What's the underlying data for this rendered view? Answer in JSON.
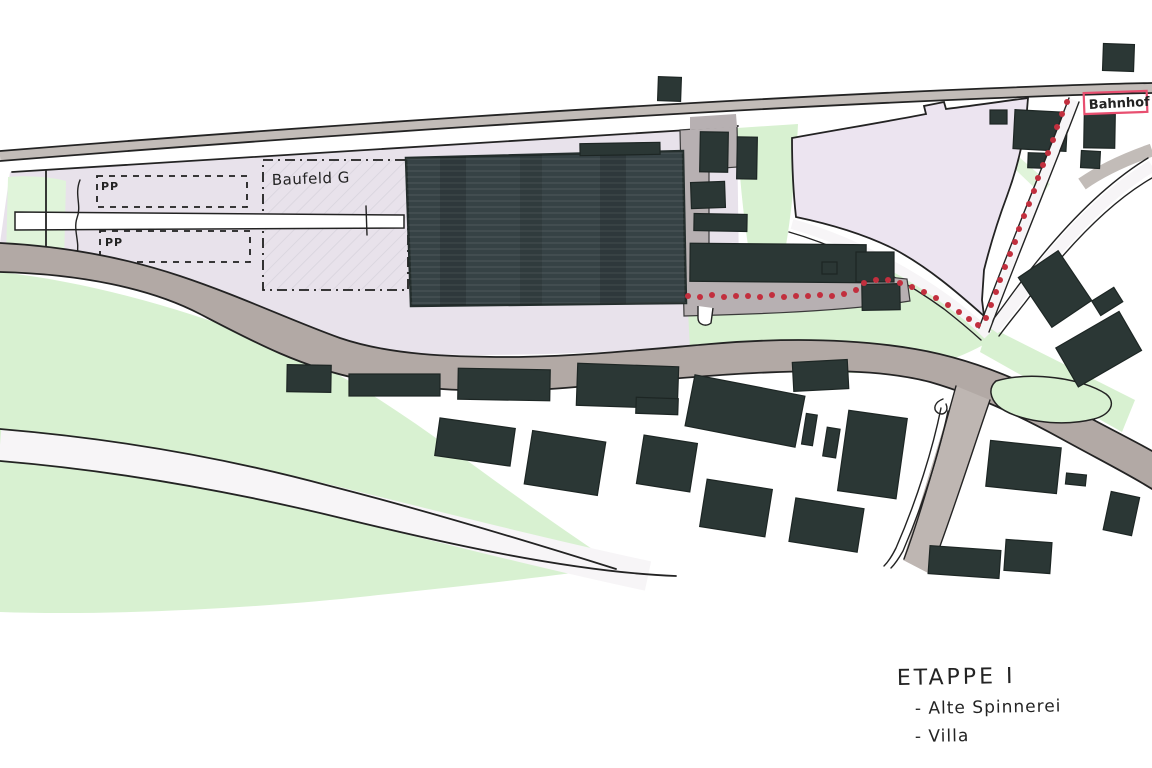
{
  "map": {
    "title": "Hand-drawn site plan sketch",
    "labels": {
      "pp_top": "PP",
      "pp_bottom": "PP",
      "baufeld": "Baufeld G",
      "bahnhof": "Bahnhof"
    }
  },
  "notes": {
    "title": "ETAPPE  I",
    "items": [
      "- Alte Spinnerei",
      "- Villa"
    ]
  },
  "colors": {
    "building_dark": "#2b3735",
    "main_hall": "#364245",
    "field_green": "#d8f1d1",
    "site_lavender": "#e8e2eb",
    "meadow_lavender": "#ece4f0",
    "road_gray": "#b2a9a5",
    "railway_gray": "#c2bcb8",
    "courtyard_gray": "#b7b0b2",
    "route_red": "#c22f3e",
    "bahnhof_box_red": "#e84f70",
    "ink": "#232323"
  }
}
